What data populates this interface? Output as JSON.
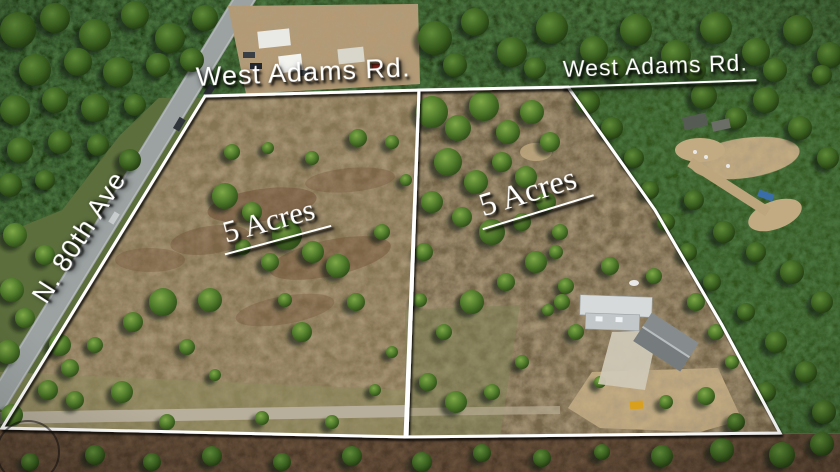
{
  "labels": {
    "road_top_left": "West Adams Rd.",
    "road_top_right": "West Adams Rd.",
    "side_street": "N. 80th Ave",
    "parcel_left_acreage": "5 Acres",
    "parcel_right_acreage": "5 Acres"
  },
  "colors": {
    "boundary_line": "#ffffff",
    "label_text": "#ffffff",
    "label_shadow": "#000000",
    "forest_green": "#2a451b",
    "field_olive": "#857452",
    "scrub_brown": "#6d4a33",
    "road_gray": "#9ca2a2",
    "dirt_tan": "#c2ab82"
  }
}
